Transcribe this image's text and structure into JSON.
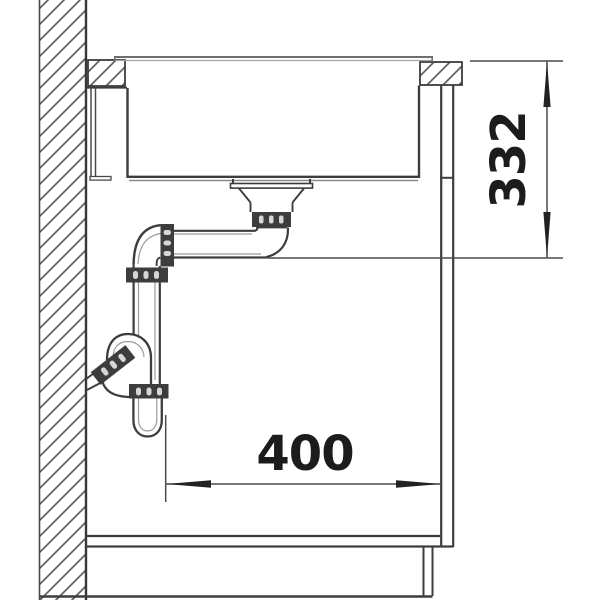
{
  "diagram": {
    "dimensions": {
      "depth": {
        "value": "332",
        "orientation": "vertical"
      },
      "clearance": {
        "value": "400",
        "orientation": "horizontal"
      }
    },
    "colors": {
      "background": "#ffffff",
      "line_dark": "#3d3d3d",
      "line_light": "#9a9a9a",
      "hatch": "#5f5f5f",
      "dimension_line": "#4a4a4a",
      "dimension_text": "#1c1c1c"
    }
  }
}
